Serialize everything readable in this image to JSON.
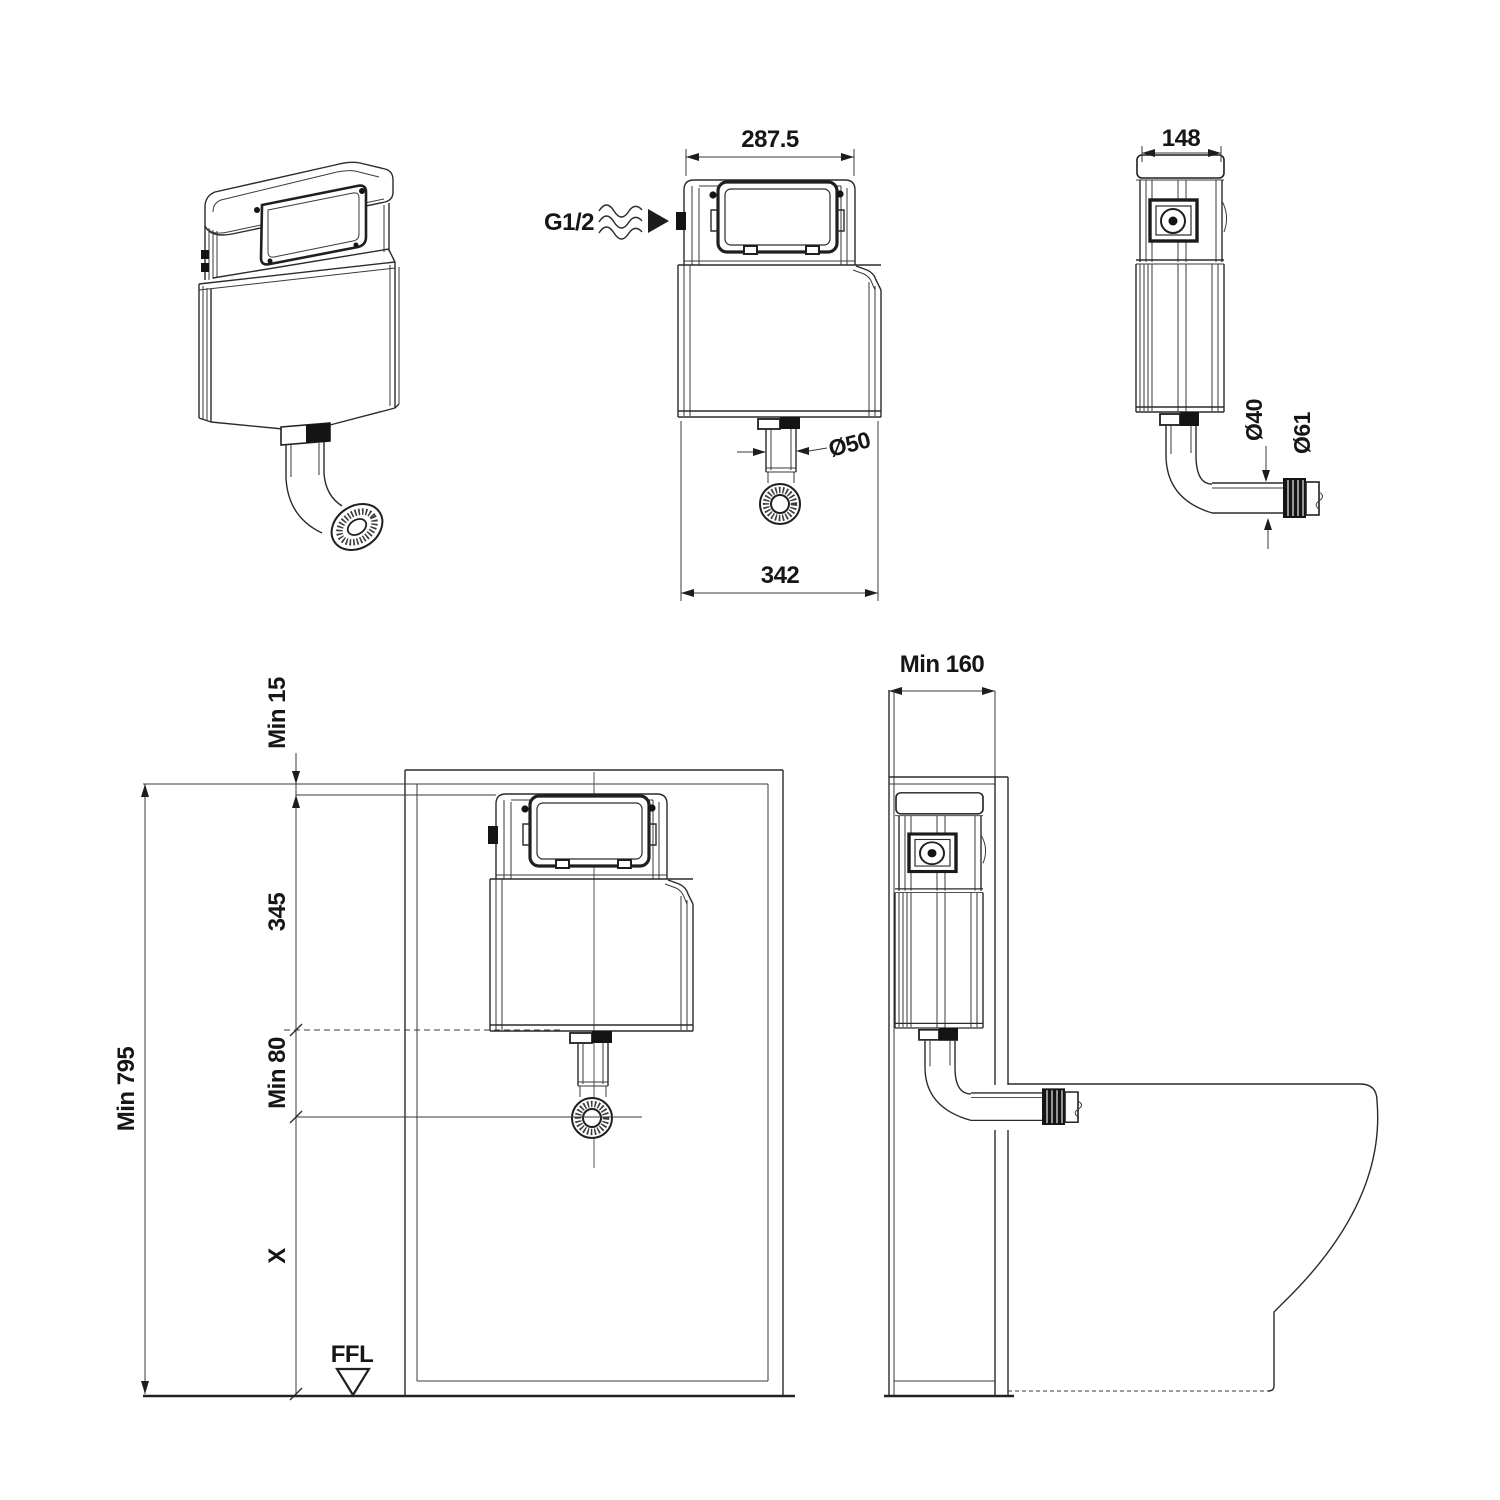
{
  "drawing_title": "Concealed cistern installation drawing",
  "colors": {
    "line": "#2b2b2b",
    "text": "#161616",
    "background": "#ffffff"
  },
  "views": {
    "front_elevation": {
      "width_top": "287.5",
      "width_bottom": "342",
      "inlet_thread": "G1/2",
      "flush_pipe_dia": "Ø50"
    },
    "side_elevation": {
      "depth": "148",
      "pipe_dia": "Ø40",
      "connector_dia": "Ø61"
    },
    "installation_front": {
      "top_clearance": "Min 15",
      "cistern_height": "345",
      "outlet_clearance": "Min 80",
      "overall_height": "Min 795",
      "variable_drop": "X",
      "floor_level": "FFL"
    },
    "installation_side": {
      "cavity_depth": "Min 160"
    }
  }
}
